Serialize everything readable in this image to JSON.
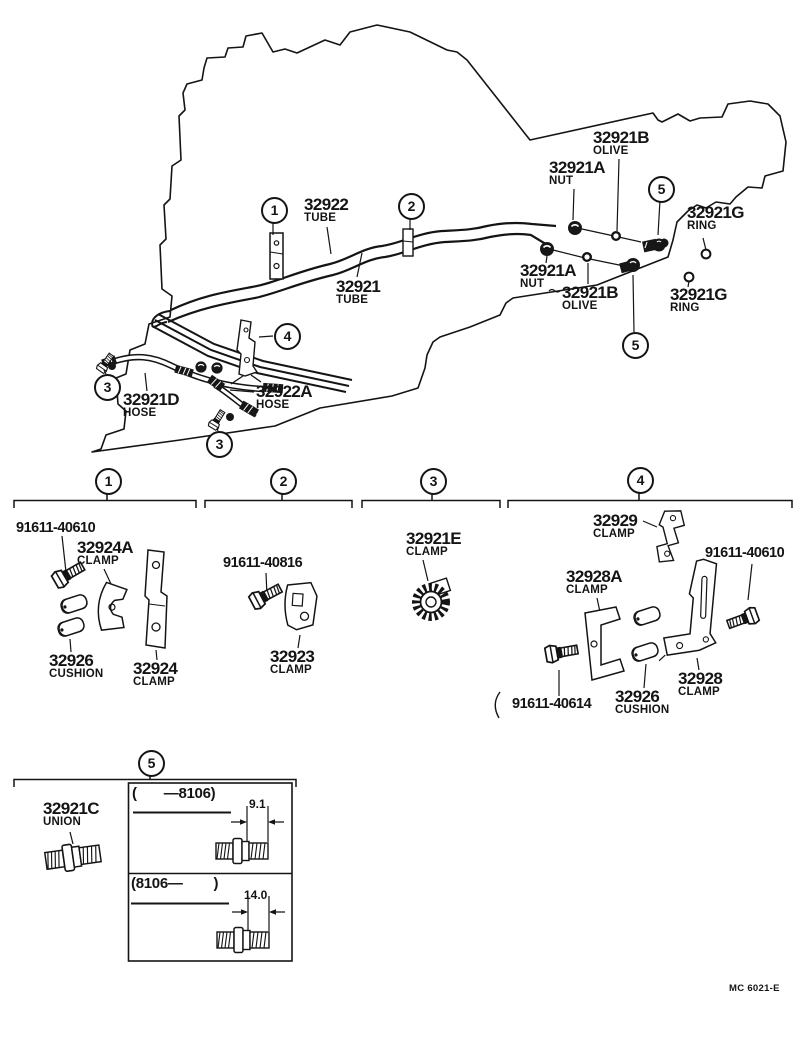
{
  "page": {
    "doc_code": "MC 6021-E"
  },
  "callouts": {
    "c1": "1",
    "c2": "2",
    "c3": "3",
    "c4": "4",
    "c5": "5"
  },
  "labels": {
    "tube_32922": {
      "part": "32922",
      "desc": "TUBE"
    },
    "tube_32921": {
      "part": "32921",
      "desc": "TUBE"
    },
    "nut_top": {
      "part": "32921A",
      "desc": "NUT"
    },
    "olive_top": {
      "part": "32921B",
      "desc": "OLIVE"
    },
    "ring_top": {
      "part": "32921G",
      "desc": "RING"
    },
    "nut_low": {
      "part": "32921A",
      "desc": "NUT"
    },
    "olive_low": {
      "part": "32921B",
      "desc": "OLIVE"
    },
    "ring_low": {
      "part": "32921G",
      "desc": "RING"
    },
    "hose_32921d": {
      "part": "32921D",
      "desc": "HOSE"
    },
    "hose_32922a": {
      "part": "32922A",
      "desc": "HOSE"
    }
  },
  "sections": {
    "s1": {
      "bolt": "91611-40610",
      "clamp_a": {
        "part": "32924A",
        "desc": "CLAMP"
      },
      "cushion": {
        "part": "32926",
        "desc": "CUSHION"
      },
      "clamp": {
        "part": "32924",
        "desc": "CLAMP"
      }
    },
    "s2": {
      "bolt": "91611-40816",
      "clamp": {
        "part": "32923",
        "desc": "CLAMP"
      }
    },
    "s3": {
      "clamp": {
        "part": "32921E",
        "desc": "CLAMP"
      }
    },
    "s4": {
      "clamp_29": {
        "part": "32929",
        "desc": "CLAMP"
      },
      "bolt_10": "91611-40610",
      "clamp_a": {
        "part": "32928A",
        "desc": "CLAMP"
      },
      "bolt_14": "91611-40614",
      "cushion": {
        "part": "32926",
        "desc": "CUSHION"
      },
      "clamp": {
        "part": "32928",
        "desc": "CLAMP"
      }
    },
    "s5": {
      "union": {
        "part": "32921C",
        "desc": "UNION"
      }
    }
  },
  "variant_table": {
    "rows": [
      {
        "range": "(       —8106)",
        "dim": "9.1"
      },
      {
        "range": "(8106—        )",
        "dim": "14.0"
      }
    ]
  }
}
